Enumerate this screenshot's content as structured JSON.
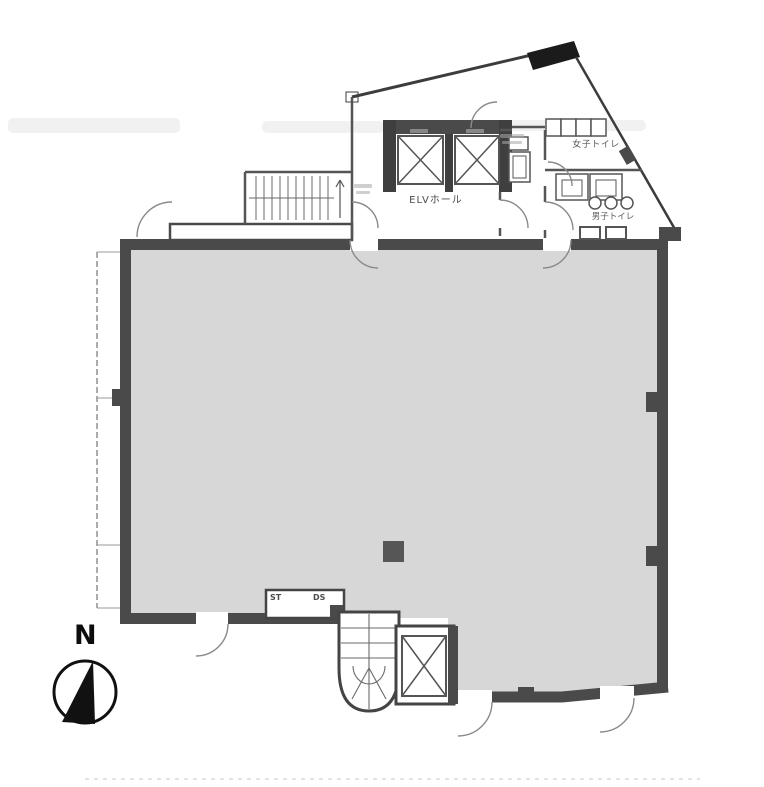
{
  "plan": {
    "labels": {
      "elv_hall": "ELVホール",
      "womens_toilet": "女子トイレ",
      "mens_toilet": "男子トイレ",
      "shaft_st": "ST",
      "shaft_ds": "DS"
    },
    "compass": {
      "north_label": "N",
      "icon": "compass-needle-icon"
    },
    "colors": {
      "wall": "#4a4a4a",
      "wall_line": "#3c3c3c",
      "floor_fill": "#d7d7d7",
      "black_accent": "#1b1b1b",
      "arc": "#8a8a8a",
      "background": "#ffffff"
    }
  }
}
